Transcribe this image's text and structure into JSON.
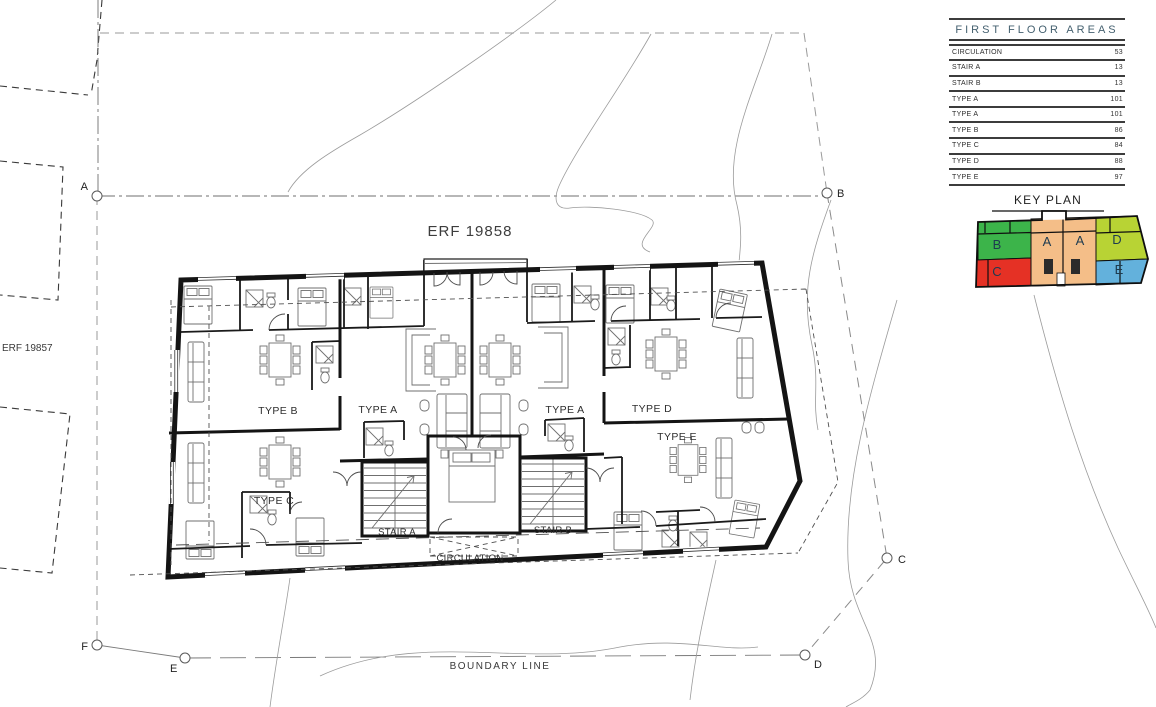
{
  "site": {
    "erf_main": "ERF 19858",
    "erf_neighbor": "ERF 19857",
    "boundary_label": "BOUNDARY LINE",
    "markers": {
      "a": "A",
      "b": "B",
      "c": "C",
      "d": "D",
      "e": "E",
      "f": "F"
    }
  },
  "plan": {
    "units": {
      "type_b": "TYPE B",
      "type_a1": "TYPE A",
      "type_a2": "TYPE A",
      "type_c": "TYPE C",
      "type_d": "TYPE D",
      "type_e": "TYPE E",
      "stair_a": "STAIR A",
      "stair_b": "STAIR B",
      "circulation": "CIRCULATION"
    }
  },
  "areas_table": {
    "title": "FIRST FLOOR AREAS",
    "rows": [
      {
        "label": "CIRCULATION",
        "value": "53"
      },
      {
        "label": "STAIR A",
        "value": "13"
      },
      {
        "label": "STAIR B",
        "value": "13"
      },
      {
        "label": "TYPE A",
        "value": "101"
      },
      {
        "label": "TYPE A",
        "value": "101"
      },
      {
        "label": "TYPE B",
        "value": "86"
      },
      {
        "label": "TYPE C",
        "value": "84"
      },
      {
        "label": "TYPE D",
        "value": "88"
      },
      {
        "label": "TYPE E",
        "value": "97"
      }
    ]
  },
  "key_plan": {
    "title": "KEY PLAN",
    "units": [
      {
        "label": "B",
        "color": "#3cb44a"
      },
      {
        "label": "A",
        "color": "#f4be88"
      },
      {
        "label": "A",
        "color": "#f4be88"
      },
      {
        "label": "D",
        "color": "#b8d334"
      },
      {
        "label": "C",
        "color": "#e53125"
      },
      {
        "label": "E",
        "color": "#63b1dc"
      }
    ]
  }
}
